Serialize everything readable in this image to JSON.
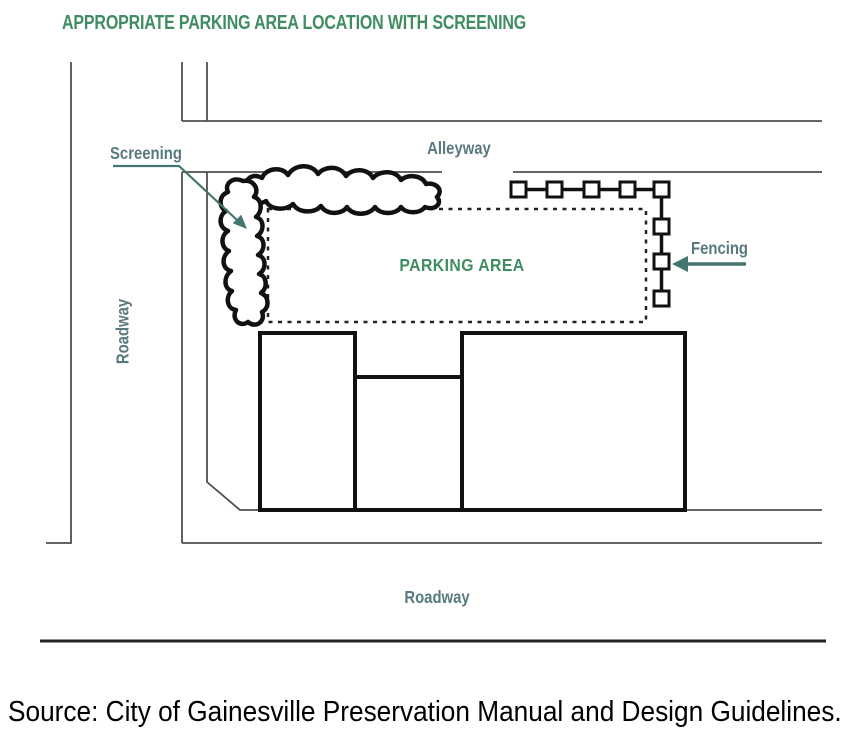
{
  "title": "APPROPRIATE PARKING AREA LOCATION WITH SCREENING",
  "diagram": {
    "street_labels": {
      "alleyway": "Alleyway",
      "roadway_left": "Roadway",
      "roadway_bottom": "Roadway"
    },
    "annotations": {
      "screening": "Screening",
      "fencing": "Fencing",
      "parking_area": "PARKING AREA"
    },
    "features": {
      "buildings_count": 3,
      "fence_posts_horizontal": 5,
      "fence_posts_vertical": 3,
      "parking_area_border_style": "dashed"
    }
  },
  "source": "Source: City of Gainesville Preservation Manual and Design Guidelines.",
  "colors": {
    "heading_green": "#3f8d60",
    "label_teal": "#587a7e",
    "arrow_teal": "#44756f",
    "line_gray": "#4f4f4f",
    "ink_black": "#111111"
  }
}
